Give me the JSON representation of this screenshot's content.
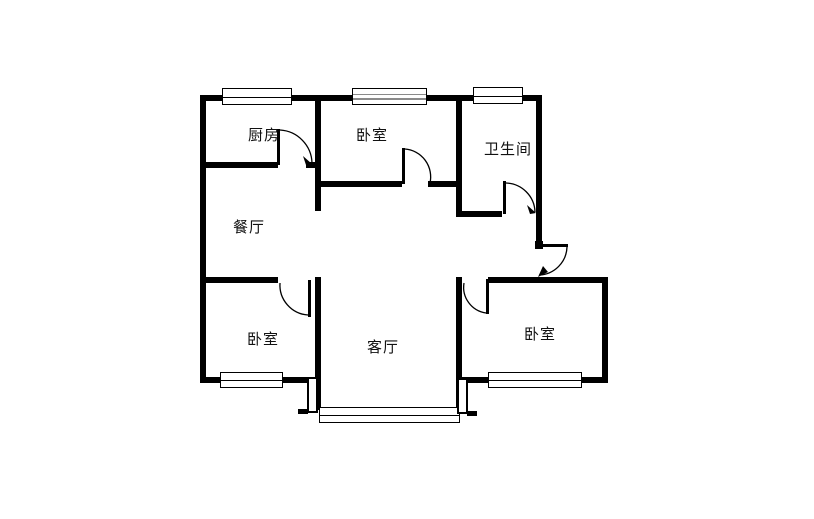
{
  "floorplan": {
    "type": "apartment-floor-plan",
    "rooms": [
      {
        "id": "kitchen",
        "label": "厨房"
      },
      {
        "id": "bedroom-top",
        "label": "卧室"
      },
      {
        "id": "bathroom",
        "label": "卫生间"
      },
      {
        "id": "dining-room",
        "label": "餐厅"
      },
      {
        "id": "bedroom-left",
        "label": "卧室"
      },
      {
        "id": "living-room",
        "label": "客厅"
      },
      {
        "id": "bedroom-right",
        "label": "卧室"
      }
    ],
    "colors": {
      "wall": "#000000",
      "background": "#ffffff",
      "text": "#111111"
    }
  }
}
